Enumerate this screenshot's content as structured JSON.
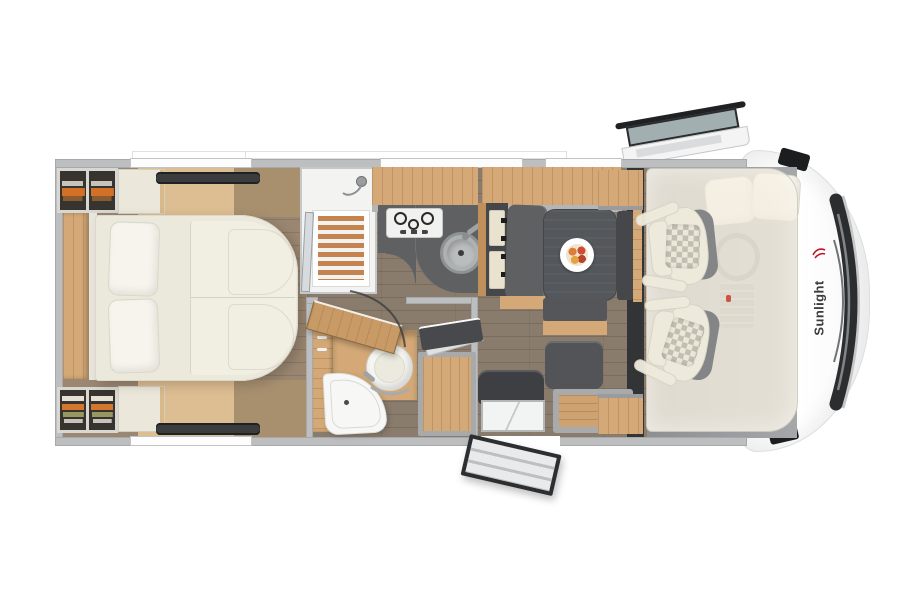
{
  "scene": {
    "type": "motorhome-floor-plan-top-view",
    "background": "#ffffff",
    "orientation": "cab-at-right, rear-bedroom-at-left"
  },
  "brand": {
    "logo_text": "Sunlight",
    "logo_text_color": "#3b3b3d",
    "logo_icon": "sunlight-bird-icon",
    "logo_icon_color": "#c41425"
  },
  "palette": {
    "wall_gray": "#bdbec0",
    "floor_wood_dark": "#8a7c6d",
    "floor_wood_light": "#ddbd92",
    "cabinet_wood": "#d4a977",
    "worktop_dark": "#5e6062",
    "upholstery_cream": "#eeeadc",
    "bench_dark": "#515356",
    "accent_orange": "#d37027",
    "vent_dark": "#3a3c3e",
    "door_glass": "#a2afb1",
    "body_white": "#fbfbfb"
  },
  "areas": {
    "bedroom": {
      "name": "rear-bedroom",
      "items": [
        "hanging-wardrobe",
        "folded-clothes-shelves",
        "overhead-lockers",
        "island-double-bed",
        "two-pillows",
        "split-duvet",
        "roof-vents",
        "side-windows"
      ]
    },
    "shower": {
      "name": "shower-cabin",
      "items": [
        "shower-head",
        "wood-shower-grate",
        "glass-door"
      ]
    },
    "kitchen": {
      "name": "kitchen-block",
      "items": [
        "overhead-cabinets",
        "three-burner-gas-hob",
        "round-sink",
        "curved-worktop",
        "tower-fridge"
      ]
    },
    "dinette": {
      "name": "half-dinette",
      "items": [
        "dining-table",
        "fruit-plate",
        "bench-seat",
        "side-benches",
        "open-storage-chest",
        "sideboard-cabinets"
      ]
    },
    "bathroom": {
      "name": "washroom",
      "items": [
        "swivel-toilet",
        "corner-washbasin",
        "vanity-cabinet",
        "open-wardrobe",
        "open-door"
      ]
    },
    "entrance": {
      "name": "entrance",
      "items": [
        "entry-step",
        "open-entrance-door",
        "travel-seat"
      ]
    },
    "cab": {
      "name": "driver-cab",
      "items": [
        "driver-seat",
        "passenger-seat",
        "drop-down-bed",
        "bed-pillows",
        "steering-wheel",
        "dashboard-console",
        "wing-mirrors",
        "windshield",
        "open-driver-door",
        "brand-logo"
      ]
    }
  }
}
